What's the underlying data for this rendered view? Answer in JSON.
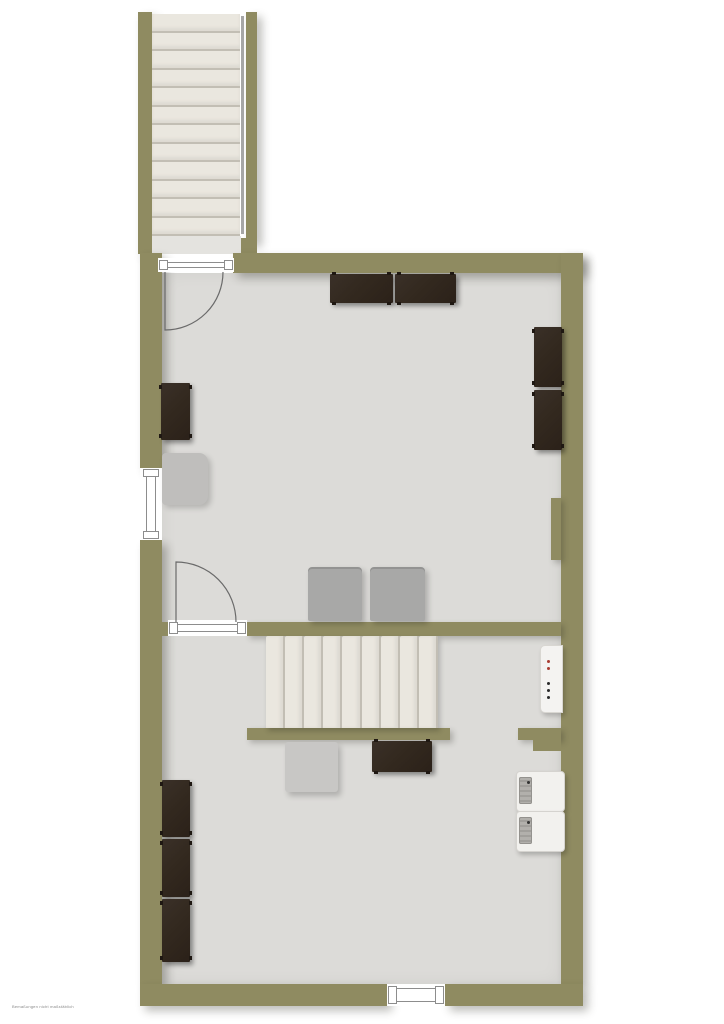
{
  "caption": "Bemaßungen nicht maßstäblich",
  "stairs": {
    "exterior_treads": 12,
    "interior_treads": 9
  },
  "boiler_indicators": {
    "red_dots": 2,
    "black_dots": 3
  },
  "colors": {
    "background": "#ffffff",
    "wall": "#8f8b61",
    "floor": "#dcdbd8",
    "tread": "#eae7df",
    "tread_edge": "#c2beb4",
    "landing": "#e4e3df",
    "handrail": "#a6a6a6",
    "furniture_dark": "#33291f",
    "furniture_feet": "#1f1812",
    "appliance_gray": "#a8a8a7",
    "chair_gray": "#bfbebc",
    "table_gray": "#c8c7c5",
    "appliance_white": "#f2f1ee",
    "panel_gray": "#b0aeaa",
    "indicator_red": "#a93c32",
    "indicator_black": "#2a2a2a",
    "door_line": "#6a6a6a",
    "frame_line": "#8d8d8d"
  }
}
